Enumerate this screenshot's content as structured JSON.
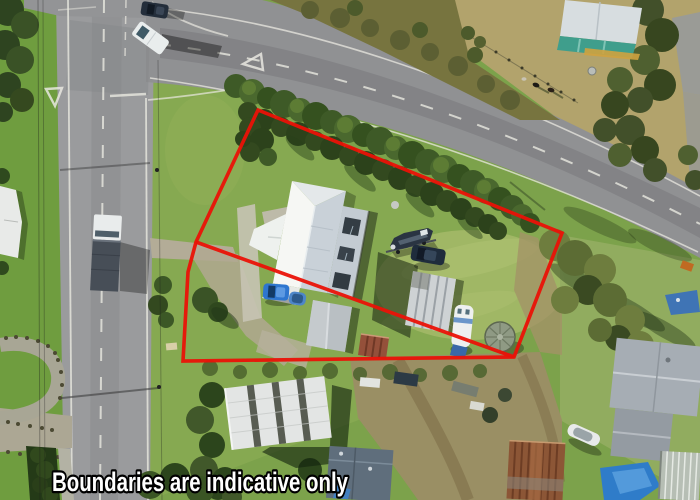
{
  "overlay": {
    "disclaimer": "Boundaries are indicative only",
    "boundary_color": "#ea1207",
    "disclaimer_fill": "#ffffff",
    "disclaimer_stroke": "#000000"
  },
  "palette": {
    "grass_base": "#7ca24b",
    "lawn_light": "#9db45e",
    "road_asphalt": "#97989a",
    "road_marking": "#e9e8e0",
    "hedge_green": "#3e5a27",
    "field_tan": "#b2a36c",
    "dirt_tan": "#9c8d66",
    "main_roof_white": "#f4f6f3",
    "main_roof_shade": "#c9d1d8",
    "warehouse_roof": "#e3e5e4",
    "neighbor_roof": "#a6adb4",
    "rusty_roof": "#8c5636",
    "teal_building": "#3f9e8c",
    "pool_blue": "#2f7cc9",
    "boat_navy": "#2a3442",
    "car_blue": "#2e76cf"
  }
}
